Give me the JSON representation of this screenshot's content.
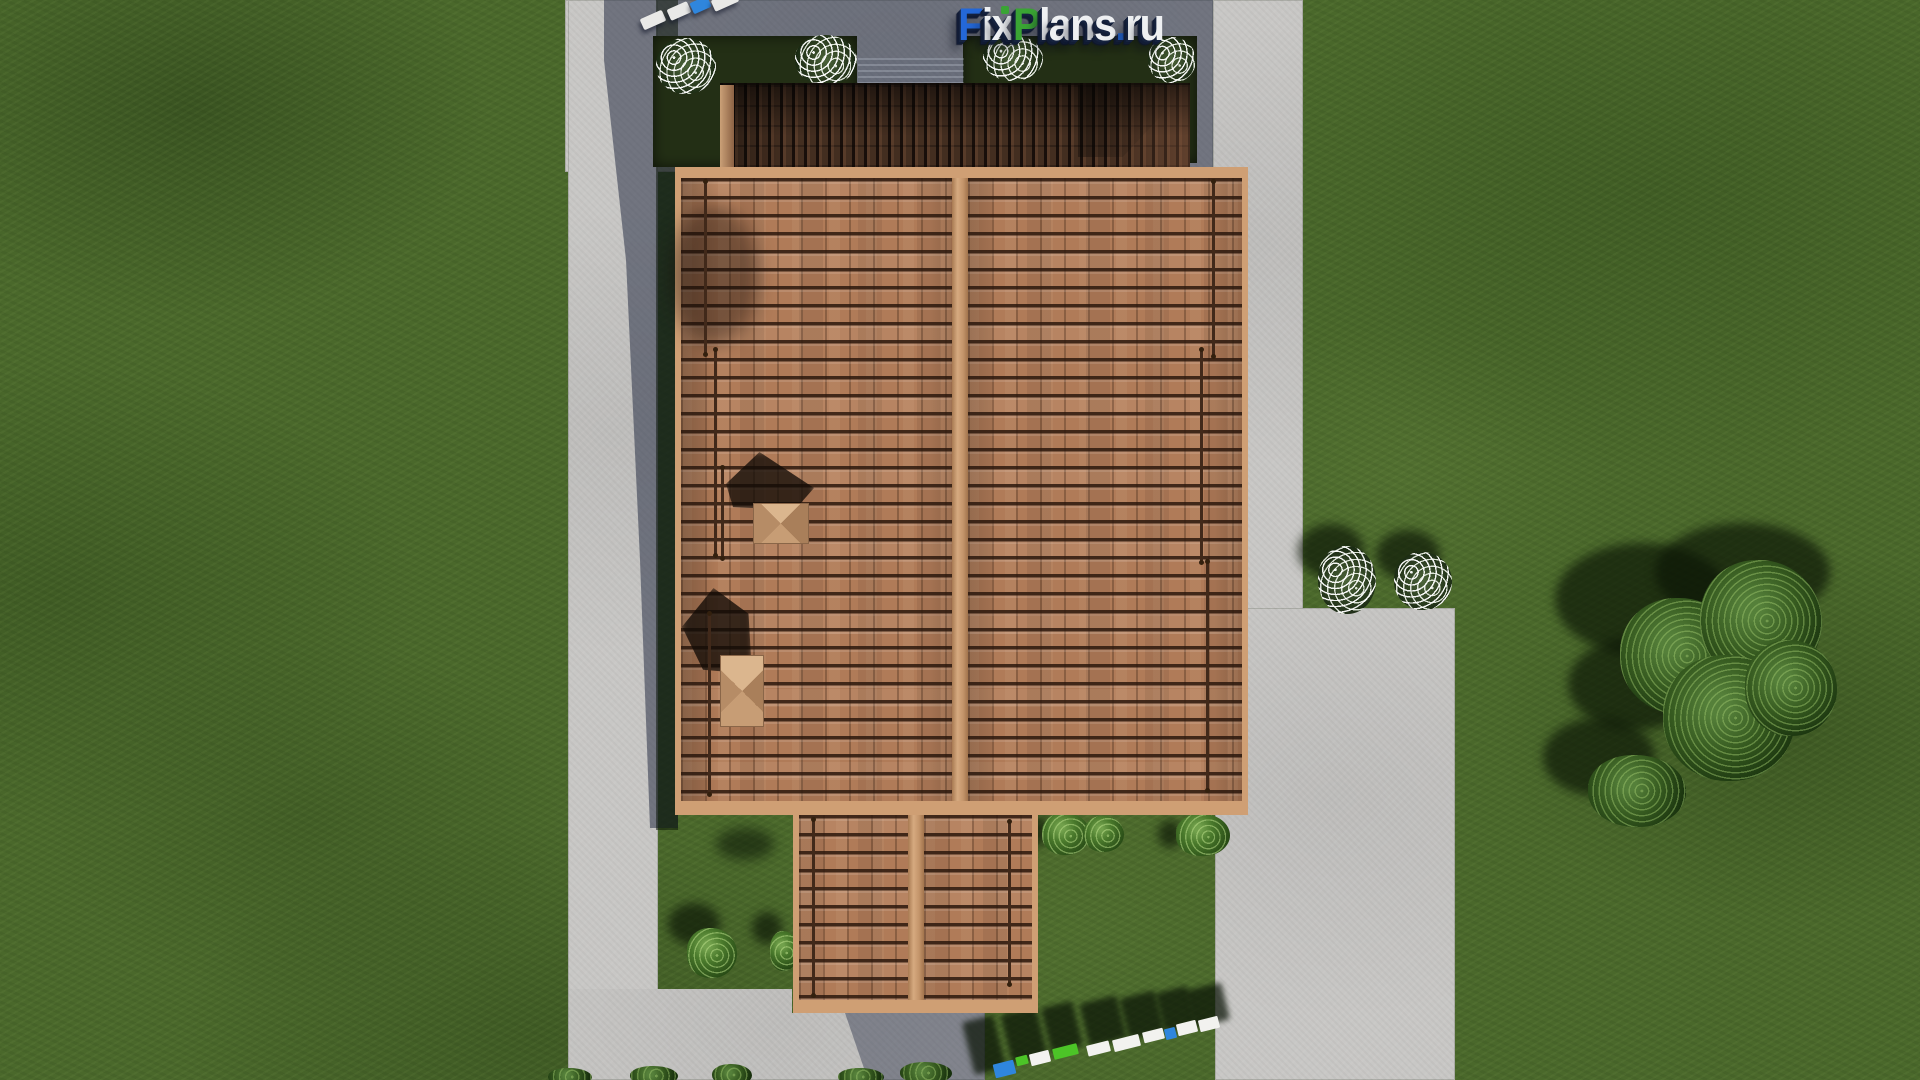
{
  "branding": {
    "watermark_text": "FixPlans.ru",
    "letters": [
      "F",
      "i",
      "x",
      "P",
      "l",
      "a",
      "n",
      "s",
      ".",
      "r",
      "u"
    ],
    "letter_colors": [
      "#2468d8",
      "#eef0f2",
      "#eef0f2",
      "#3aa434",
      "#eef0f2",
      "#eef0f2",
      "#eef0f2",
      "#eef0f2",
      "#2468d8",
      "#eef0f2",
      "#eef0f2"
    ],
    "i_dot_color": "#3aa434"
  },
  "ground_watermark": {
    "text": "FixPlans.ru",
    "block_colors": {
      "blue": "#2f86dd",
      "green": "#4cc427",
      "white": "#f2f2ef"
    }
  },
  "palette": {
    "grass": "#4a682b",
    "grass_shadowed": "#20330f",
    "pavement": "#c8c7c5",
    "pavement_shadowed": "#6e7585",
    "roof_tile": "#b07b58",
    "roof_tile_shadow_lines": "#2c180d",
    "roof_trim": "#cf9f74",
    "roof_ridge": "#c89a72",
    "back_roof_shadowed": "#452f22",
    "flowerbed": "#232f15",
    "shrub_green": "#4a7a2c",
    "tree_green": "#35591f",
    "flower_white": "#ffffff",
    "stepping_stone_white": "#e9e9e7",
    "stepping_stone_blue": "#2f86dd"
  }
}
